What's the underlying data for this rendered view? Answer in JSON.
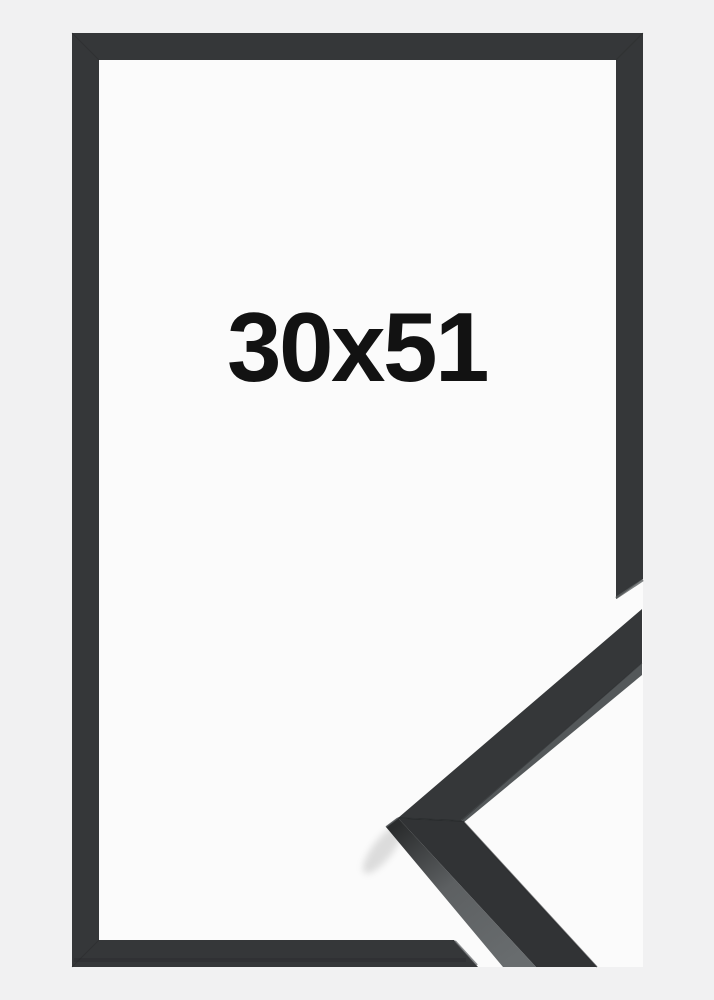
{
  "size_label": "30x51",
  "colors": {
    "background": "#f1f1f2",
    "opening": "#fbfbfb",
    "frame": "#353739",
    "frame_lower_leg": "#313335",
    "seam_dark": "#242628",
    "seam_soft": "#2a2c2d",
    "cut_face": "#5d6062",
    "side_stripe": "#54585a",
    "side_dark": "#2a2c2d",
    "side_light": "#686c6e",
    "apex_ridge": "#515456",
    "bottom_bar_shade": "#27292a",
    "text": "#121212",
    "shadow": "#000000"
  }
}
